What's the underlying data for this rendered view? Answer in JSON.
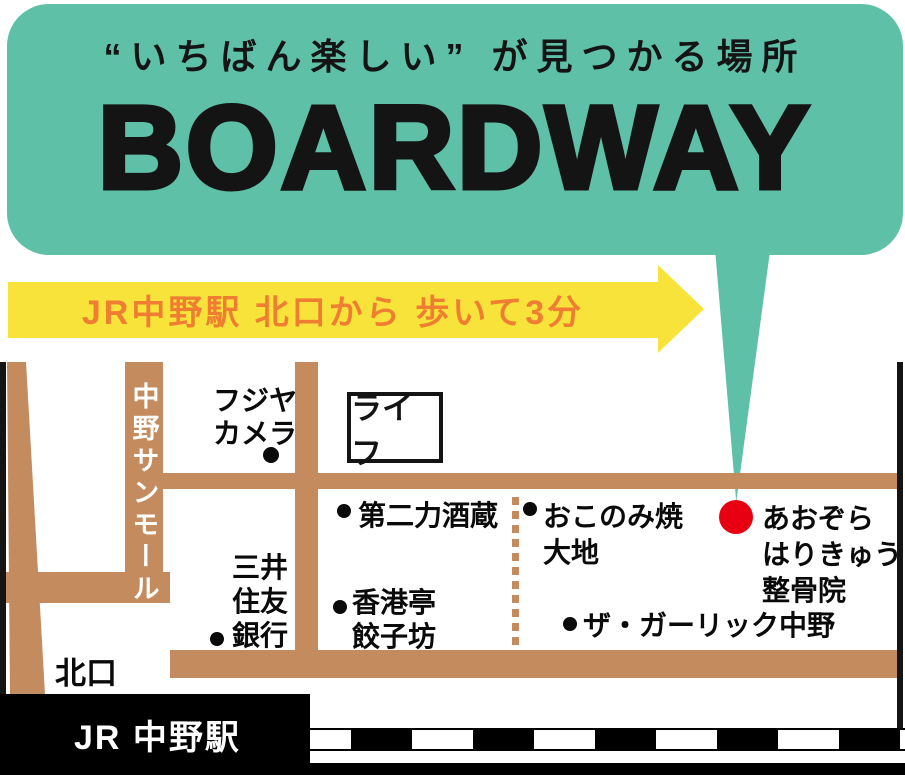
{
  "bubble": {
    "tagline": "“いちばん楽しい” が見つかる場所",
    "brand": "BOARDWAY"
  },
  "arrow": {
    "label": "JR中野駅 北口から 歩いて3分"
  },
  "map": {
    "sunmall": "中野サンモール",
    "landmarks": {
      "fujiya": "フジヤ\nカメラ",
      "life": "ライフ",
      "dainiriki": "第二力酒蔵",
      "okonomiyaki": "おこのみ焼\n大地",
      "aozora": "あおぞら\nはりきゅう\n整骨院",
      "mitsui_bank": "三井\n住友\n銀行",
      "honkontei": "香港亭\n餃子坊",
      "garlic": "ザ・ガーリック中野",
      "north_exit": "北口",
      "station": "JR 中野駅"
    },
    "colors": {
      "bubble_teal": "#5EC0A6",
      "street_tan": "#C48C5E",
      "arrow_yellow": "#F8E33B",
      "arrow_text_orange": "#EF7E32",
      "marker_red": "#E60012",
      "text_black": "#141414"
    }
  }
}
